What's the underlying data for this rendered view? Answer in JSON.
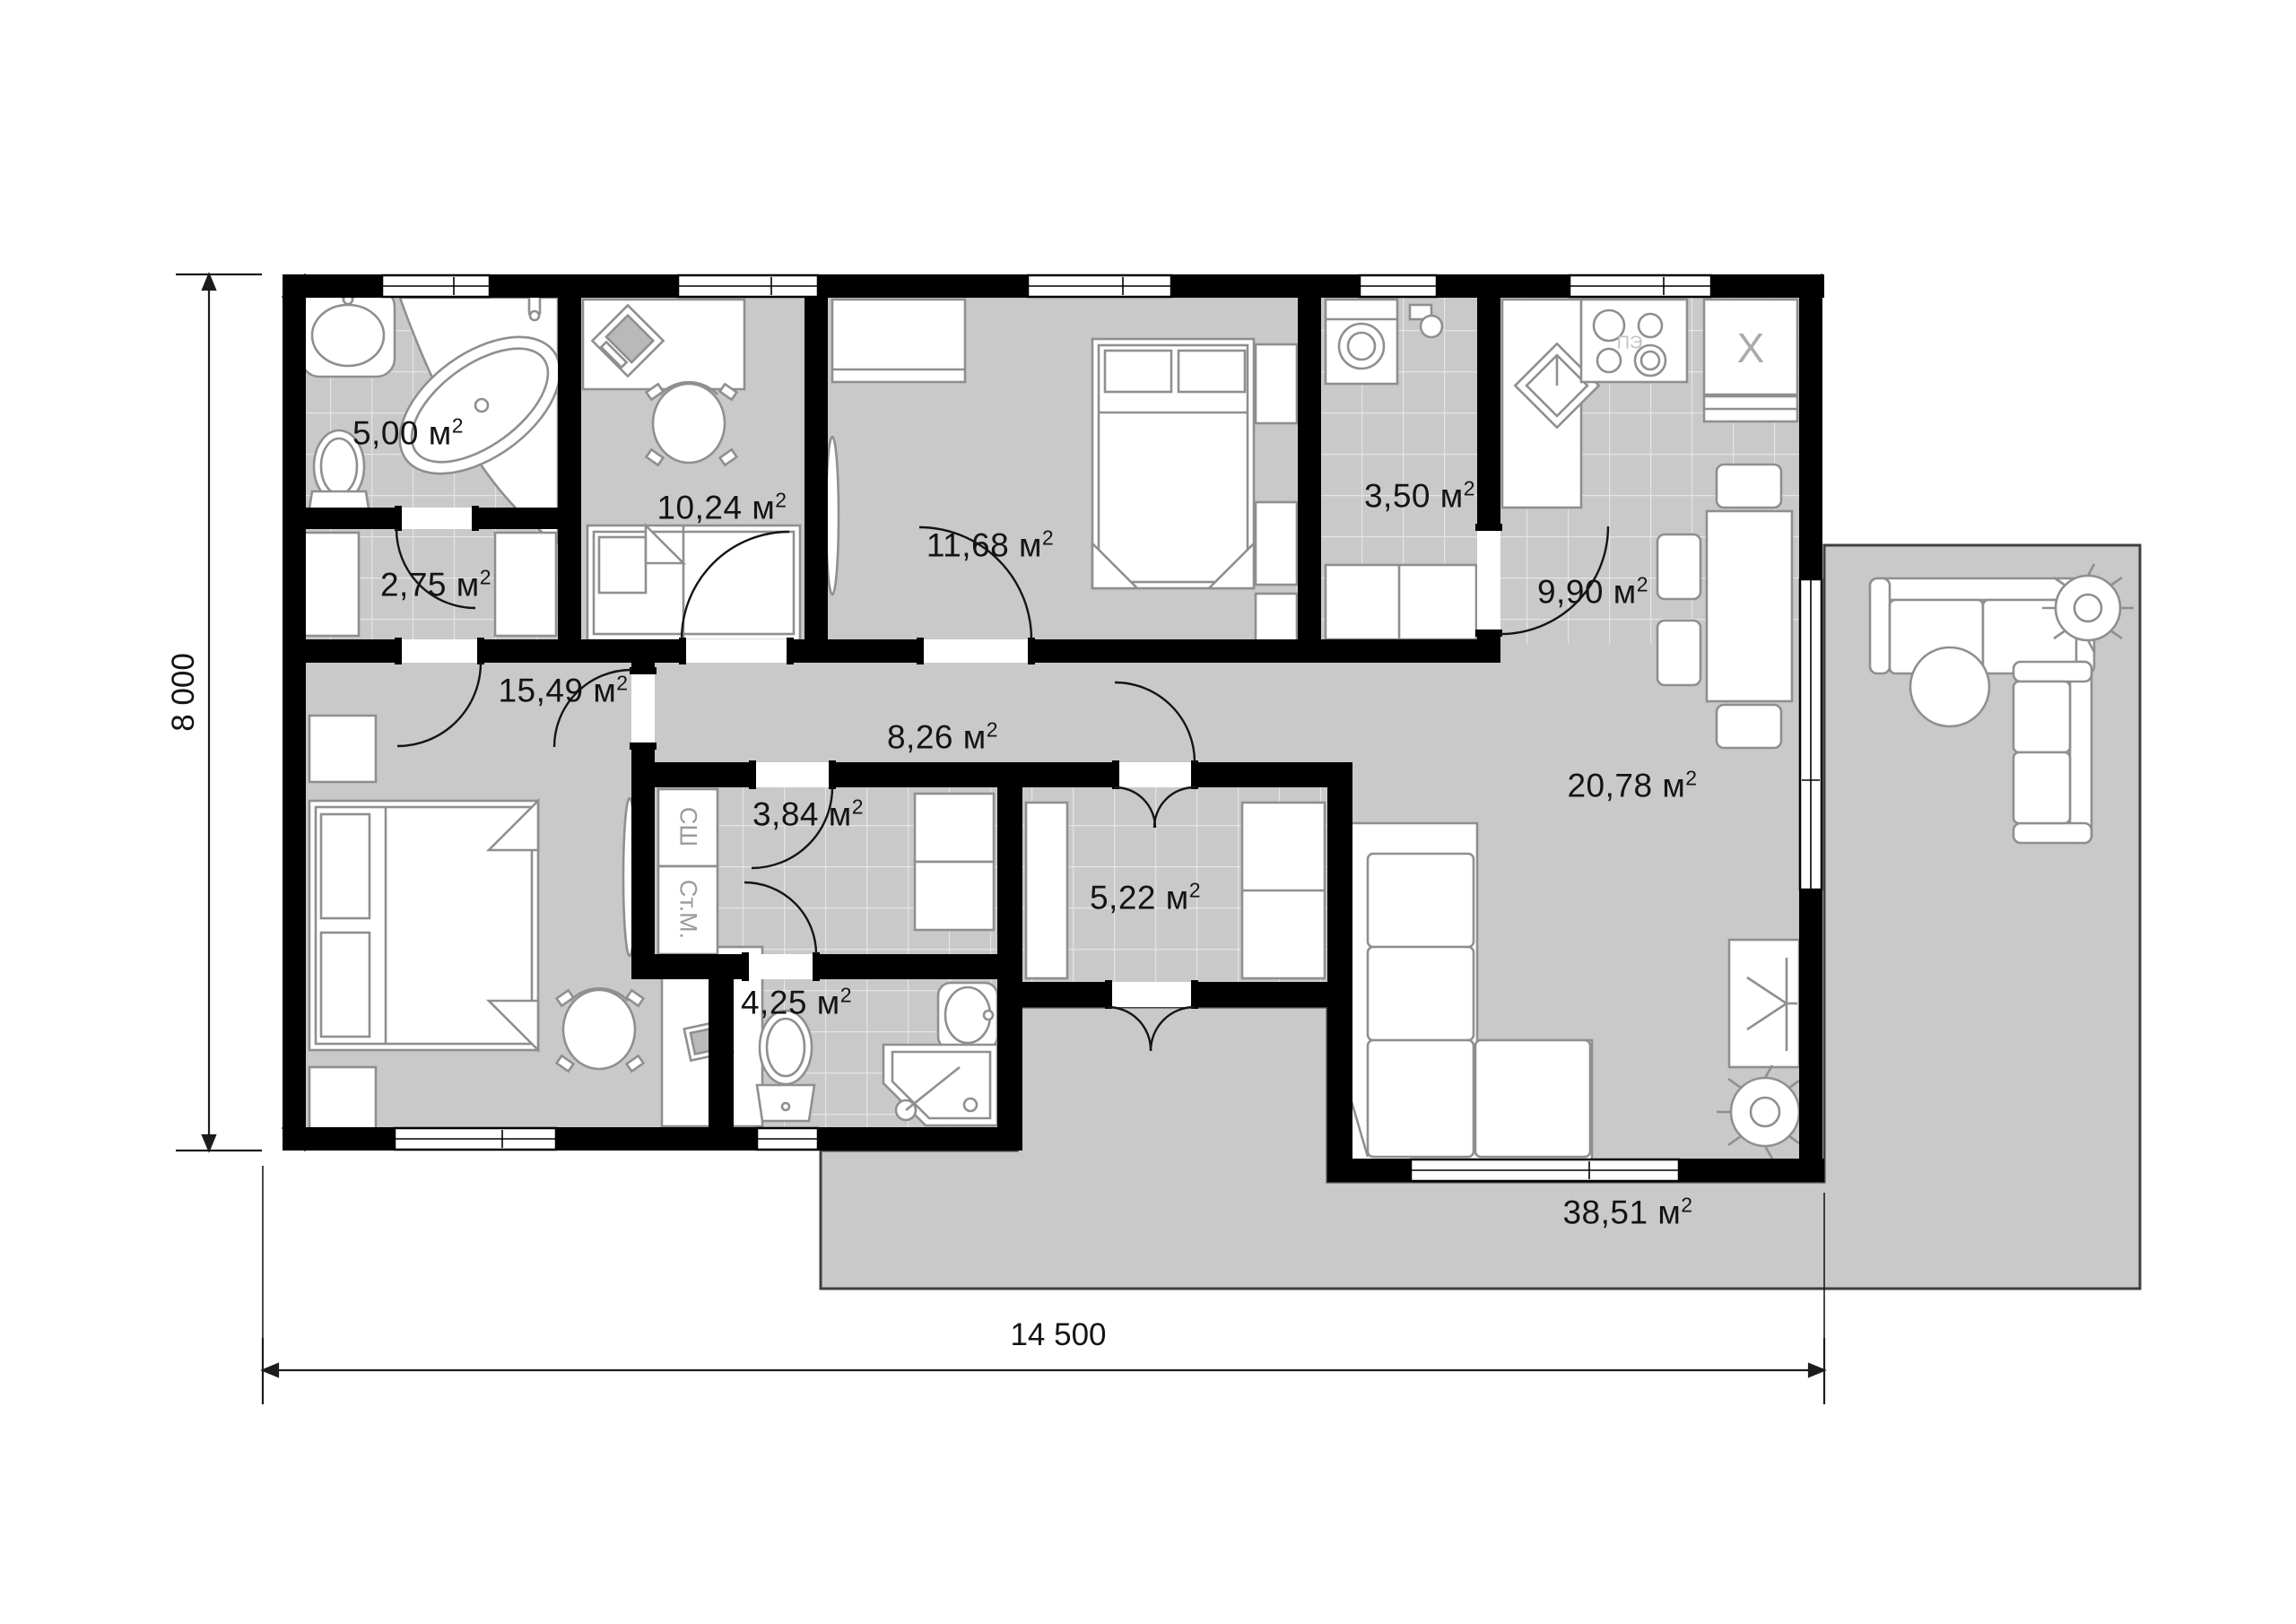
{
  "plan": {
    "rooms": [
      {
        "id": "bathroom-1",
        "area_value": "5,00",
        "area_unit": "м",
        "area_sup": "2"
      },
      {
        "id": "dressing-room",
        "area_value": "2,75",
        "area_unit": "м",
        "area_sup": "2"
      },
      {
        "id": "kids-room",
        "area_value": "10,24",
        "area_unit": "м",
        "area_sup": "2"
      },
      {
        "id": "bedroom",
        "area_value": "11,68",
        "area_unit": "м",
        "area_sup": "2"
      },
      {
        "id": "bathroom-2",
        "area_value": "3,50",
        "area_unit": "м",
        "area_sup": "2"
      },
      {
        "id": "kitchen",
        "area_value": "9,90",
        "area_unit": "м",
        "area_sup": "2"
      },
      {
        "id": "master-bedroom",
        "area_value": "15,49",
        "area_unit": "м",
        "area_sup": "2"
      },
      {
        "id": "hallway",
        "area_value": "8,26",
        "area_unit": "м",
        "area_sup": "2"
      },
      {
        "id": "laundry",
        "area_value": "3,84",
        "area_unit": "м",
        "area_sup": "2"
      },
      {
        "id": "entry",
        "area_value": "5,22",
        "area_unit": "м",
        "area_sup": "2"
      },
      {
        "id": "bathroom-3",
        "area_value": "4,25",
        "area_unit": "м",
        "area_sup": "2"
      },
      {
        "id": "living-room",
        "area_value": "20,78",
        "area_unit": "м",
        "area_sup": "2"
      },
      {
        "id": "terrace",
        "area_value": "38,51",
        "area_unit": "м",
        "area_sup": "2"
      }
    ],
    "dimensions": {
      "height": "8 000",
      "width": "14 500"
    },
    "annotations": {
      "drying_cabinet": "СШ",
      "washing_machine": "Ст.М.",
      "refrigerator_mark": "X",
      "stove_mark": "ПЭ"
    },
    "furniture": [
      "wash-basin",
      "bathtub",
      "toilet",
      "wardrobe",
      "desk",
      "computer",
      "office-chair",
      "single-bed",
      "double-bed",
      "nightstand",
      "mirror",
      "washing-machine",
      "vanity-unit",
      "corner-sink",
      "stove",
      "refrigerator",
      "dining-table",
      "chair",
      "corner-sofa",
      "tv-stand",
      "plant",
      "shower-cabin",
      "outdoor-sofa",
      "round-table"
    ],
    "colors": {
      "wall": "#000000",
      "floor": "#c9c9c9",
      "tile_line": "#e4e4e4",
      "furniture_stroke": "#8f8f8f",
      "dimension": "#1c1c1c",
      "muted_text": "#9a9a9a"
    }
  }
}
